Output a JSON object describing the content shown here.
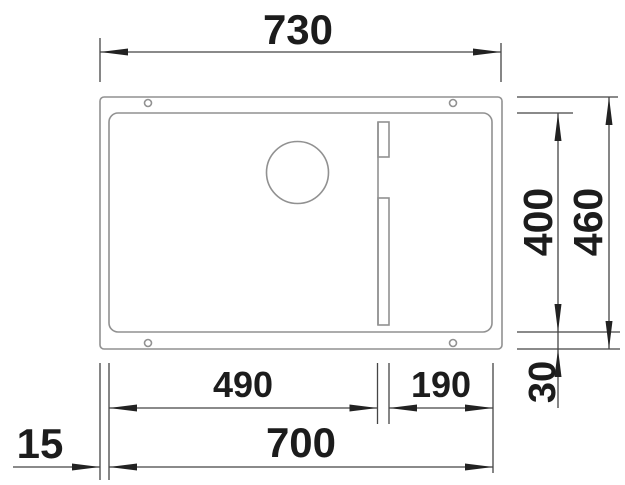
{
  "palette": {
    "background": "#ffffff",
    "sink_outline": "#919191",
    "dimension_lines": "#454545",
    "text": "#1c1c1c"
  },
  "dimensions": {
    "overall_width": "730",
    "bowl_depth": "400",
    "overall_depth": "460",
    "bottom_edge_depth": "30",
    "bowl_section_left": "490",
    "bowl_section_right": "190",
    "bowl_width": "700",
    "side_edge_width": "15"
  }
}
